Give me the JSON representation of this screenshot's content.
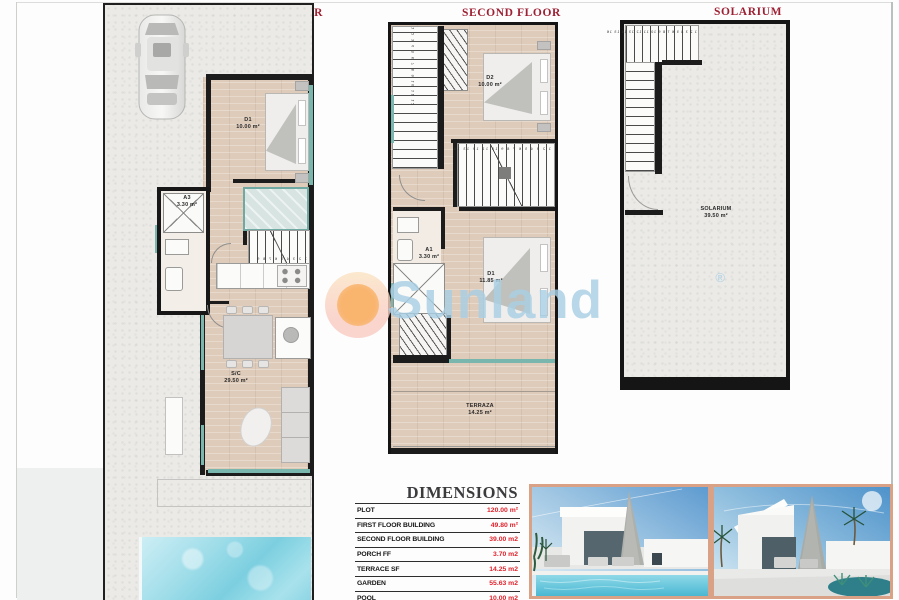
{
  "titles": {
    "first_floor": "FIRST FLOOR",
    "second_floor": "SECOND FLOOR",
    "solarium": "SOLARIUM"
  },
  "watermark": {
    "brand": "Sunland",
    "registered_mark": "®"
  },
  "plans": {
    "first_floor": {
      "rooms": [
        {
          "name": "D1",
          "area": "10.00 m²"
        },
        {
          "name": "A3",
          "area": "3.30 m²"
        },
        {
          "name": "S/C",
          "area": "29.50 m²"
        }
      ],
      "stair_numbers": "1 2 3 4 5 6 7 8 9"
    },
    "second_floor": {
      "rooms": [
        {
          "name": "D2",
          "area": "10.00 m²"
        },
        {
          "name": "A1",
          "area": "3.30 m²"
        },
        {
          "name": "D1",
          "area": "11.85 m²"
        },
        {
          "name": "TERRAZA",
          "area": "14.25 m²"
        }
      ],
      "stair_numbers_upper": "1 2 3 4 5 6 7 8 9 10 11 12",
      "stair_numbers_mid": "1 2 3 4 5 6 7 8 9 10 11 12 13 14"
    },
    "solarium": {
      "rooms": [
        {
          "name": "SOLARIUM",
          "area": "39.50 m²"
        }
      ],
      "stair_numbers": "1 2 3 4 5 6 7 8 9 10 11 12 13 14 15 16"
    }
  },
  "dimensions_table": {
    "title": "DIMENSIONS",
    "rows": [
      {
        "label": "PLOT",
        "value": "120.00 m²"
      },
      {
        "label": "FIRST FLOOR BUILDING",
        "value": "49.80 m²"
      },
      {
        "label": "SECOND FLOOR BUILDING",
        "value": "39.00 m2"
      },
      {
        "label": "PORCH FF",
        "value": "3.70 m2"
      },
      {
        "label": "TERRACE SF",
        "value": "14.25 m2"
      },
      {
        "label": "GARDEN",
        "value": "55.63 m2"
      },
      {
        "label": "POOL",
        "value": "10.00 m2"
      }
    ]
  },
  "colors": {
    "plan_title_red": "#9e2033",
    "table_value_red": "#e2212b",
    "window_teal": "#79b7ae",
    "floor_tan": "#dfcbba",
    "wall_black": "#1c1c1c",
    "watermark_blue": "#a9cfe4",
    "photo_border": "#d9a287"
  }
}
